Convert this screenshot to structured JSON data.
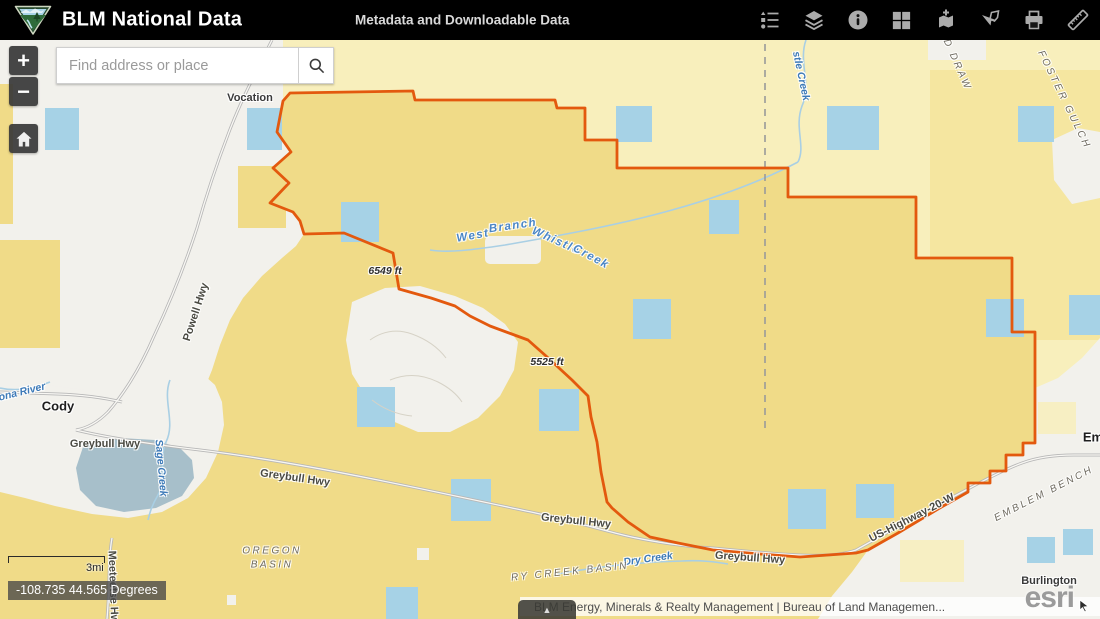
{
  "header": {
    "title": "BLM National Data",
    "subtitle": "Metadata and Downloadable Data",
    "tools": [
      {
        "name": "legend"
      },
      {
        "name": "layers"
      },
      {
        "name": "information"
      },
      {
        "name": "basemap-grid"
      },
      {
        "name": "add-data"
      },
      {
        "name": "extract-data"
      },
      {
        "name": "print"
      },
      {
        "name": "measure"
      }
    ]
  },
  "search": {
    "placeholder": "Find address or place"
  },
  "map_controls": {
    "zoom_in": "+",
    "zoom_out": "−"
  },
  "scale": {
    "label": "3mi"
  },
  "coordinates": {
    "text": "-108.735 44.565 Degrees"
  },
  "attribution": {
    "text": "BLM Energy, Minerals & Realty Management | Bureau of Land Managemen...",
    "logo": "esri",
    "expander": "▲"
  },
  "colors": {
    "header_bg": "#000000",
    "land_yellow": "#f0db88",
    "land_pale": "#f8efbc",
    "land_medium": "#f4e49c",
    "land_white": "#f2f1ec",
    "parcel_blue": "#a6d2e6",
    "boundary_orange": "#e3590e",
    "water_line": "#a9cfe4",
    "urban_blue_gray": "#a7bfca"
  },
  "map_labels": [
    {
      "text": "Vocation",
      "x": 250,
      "y": 58,
      "rot": 0,
      "cls": "place"
    },
    {
      "text": "Cody",
      "x": 58,
      "y": 366,
      "rot": 0,
      "cls": "town"
    },
    {
      "text": "Burlington",
      "x": 1049,
      "y": 541,
      "rot": 0,
      "cls": "place"
    },
    {
      "text": "Em",
      "x": 1093,
      "y": 397,
      "rot": 0,
      "cls": "town"
    },
    {
      "text": "6549 ft",
      "x": 385,
      "y": 231,
      "rot": 0,
      "cls": "elev"
    },
    {
      "text": "5525 ft",
      "x": 547,
      "y": 322,
      "rot": 0,
      "cls": "elev"
    },
    {
      "text": "Greybull Hwy",
      "x": 105,
      "y": 404,
      "rot": 0,
      "cls": "road"
    },
    {
      "text": "Greybull Hwy",
      "x": 295,
      "y": 438,
      "rot": 8,
      "cls": "road"
    },
    {
      "text": "Greybull Hwy",
      "x": 576,
      "y": 481,
      "rot": 6,
      "cls": "road"
    },
    {
      "text": "Greybull Hwy",
      "x": 750,
      "y": 518,
      "rot": 4,
      "cls": "road"
    },
    {
      "text": "Powell Hwy",
      "x": 196,
      "y": 272,
      "rot": -72,
      "cls": "road"
    },
    {
      "text": "US-Highway-20-W",
      "x": 912,
      "y": 478,
      "rot": -27,
      "cls": "road"
    },
    {
      "text": "Meeteetse Hwy",
      "x": 113,
      "y": 550,
      "rot": 88,
      "cls": "road"
    },
    {
      "text": "Sage Creek",
      "x": 161,
      "y": 428,
      "rot": 85,
      "cls": "water"
    },
    {
      "text": "ona River",
      "x": 22,
      "y": 352,
      "rot": -14,
      "cls": "water"
    },
    {
      "text": "stle Creek",
      "x": 801,
      "y": 36,
      "rot": 78,
      "cls": "water"
    },
    {
      "text": "Dry Creek",
      "x": 648,
      "y": 519,
      "rot": -8,
      "cls": "water"
    },
    {
      "text": "West",
      "x": 473,
      "y": 196,
      "rot": -10,
      "cls": "water2"
    },
    {
      "text": "Branch",
      "x": 513,
      "y": 186,
      "rot": -8,
      "cls": "water2"
    },
    {
      "text": "Whistle",
      "x": 556,
      "y": 201,
      "rot": 24,
      "cls": "water2"
    },
    {
      "text": "Creek",
      "x": 591,
      "y": 217,
      "rot": 28,
      "cls": "water2"
    },
    {
      "text": "OREGON",
      "x": 272,
      "y": 511,
      "rot": 0,
      "cls": "area"
    },
    {
      "text": "BASIN",
      "x": 272,
      "y": 525,
      "rot": 0,
      "cls": "area"
    },
    {
      "text": "RY CREEK BASIN",
      "x": 570,
      "y": 532,
      "rot": -6,
      "cls": "area"
    },
    {
      "text": "EMBLEM BENCH",
      "x": 1044,
      "y": 454,
      "rot": -27,
      "cls": "area"
    },
    {
      "text": "FOSTER GULCH",
      "x": 1064,
      "y": 60,
      "rot": 64,
      "cls": "area"
    },
    {
      "text": "D DRAW",
      "x": 957,
      "y": 25,
      "rot": 66,
      "cls": "area"
    }
  ],
  "map_squares": [
    [
      45,
      68,
      34,
      42
    ],
    [
      247,
      68,
      35,
      42
    ],
    [
      616,
      66,
      36,
      36
    ],
    [
      827,
      66,
      52,
      44
    ],
    [
      1018,
      66,
      36,
      36
    ],
    [
      341,
      162,
      38,
      40
    ],
    [
      709,
      160,
      30,
      34
    ],
    [
      633,
      259,
      38,
      40
    ],
    [
      986,
      259,
      38,
      38
    ],
    [
      1069,
      255,
      31,
      40
    ],
    [
      357,
      347,
      38,
      40
    ],
    [
      539,
      349,
      40,
      42
    ],
    [
      451,
      439,
      40,
      42
    ],
    [
      788,
      449,
      38,
      40
    ],
    [
      856,
      444,
      38,
      34
    ],
    [
      386,
      547,
      32,
      32
    ],
    [
      1027,
      497,
      28,
      26
    ],
    [
      1063,
      489,
      30,
      26
    ]
  ]
}
